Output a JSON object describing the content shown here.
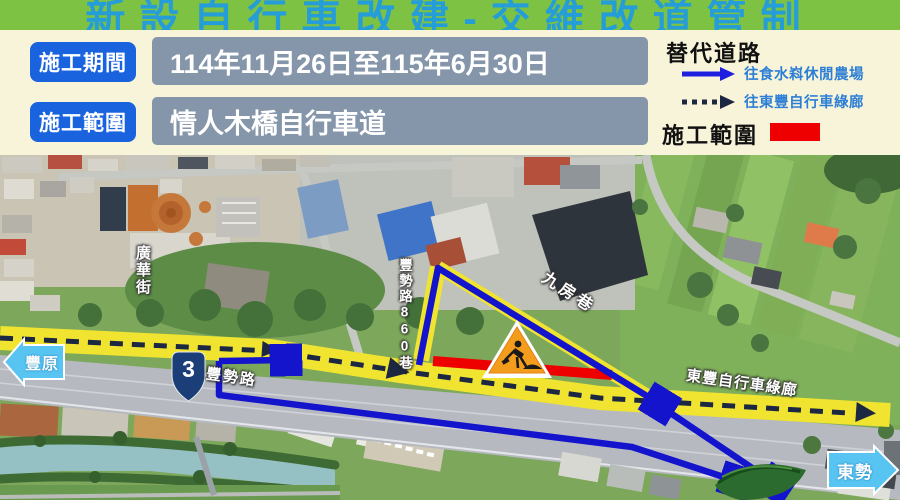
{
  "title": "新設自行車改建-交維改道管制",
  "info": {
    "rows": [
      {
        "label": "施工期間",
        "value": "114年11月26日至115年6月30日"
      },
      {
        "label": "施工範圍",
        "value": "情人木橋自行車道"
      }
    ]
  },
  "legend": {
    "title": "替代道路",
    "items": [
      {
        "style": "solid-arrow",
        "label": "往食水嵙休閒農場"
      },
      {
        "style": "dotted-arrow",
        "label": "往東豐自行車綠廊"
      }
    ],
    "scope_label": "施工範圍",
    "scope_color": "#ee0000"
  },
  "map": {
    "labels": {
      "guanghua_street": "廣華街",
      "fengshi_860_lane": "豐勢路860巷",
      "jiufang_lane": "九房巷",
      "fengshi_road": "豐勢路",
      "dongfeng_corridor": "東豐自行車綠廊",
      "fengyuan": "豐原",
      "dongshi": "東勢",
      "route_shield": "3"
    }
  },
  "colors": {
    "header_green": "#7dc242",
    "title_blue": "#249dd8",
    "tag_blue": "#1a63de",
    "value_box_gray": "#8596aa",
    "route_blue": "#1414cc",
    "detour_dash_navy": "#1c2742",
    "construction_red": "#ee0000",
    "bike_path_yellow": "#f0e430",
    "direction_arrow_blue": "#58c4f2",
    "shield_navy": "#1c3e78"
  }
}
